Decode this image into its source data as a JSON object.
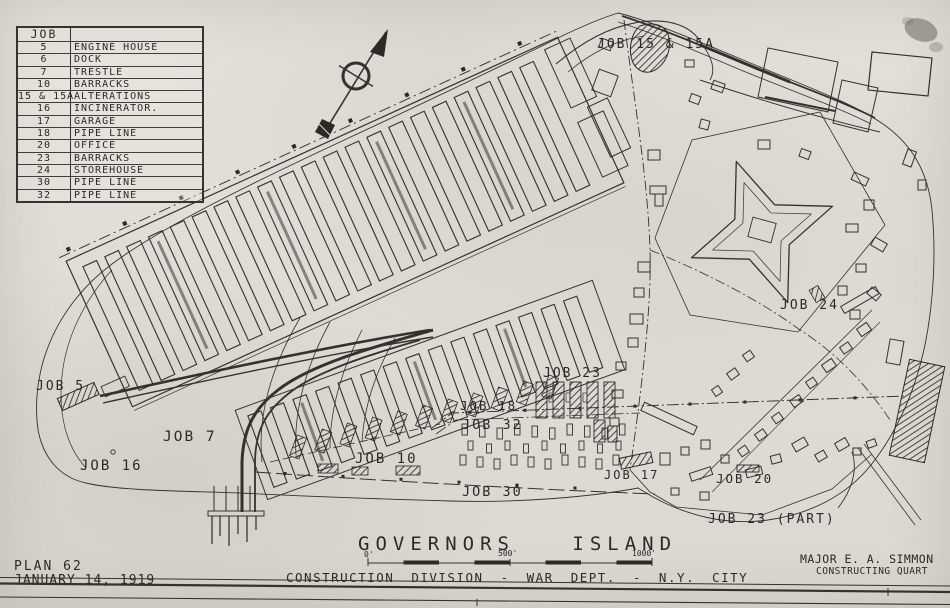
{
  "legend": {
    "header": "JOB",
    "rows": [
      {
        "job": "5",
        "name": "ENGINE HOUSE"
      },
      {
        "job": "6",
        "name": "DOCK"
      },
      {
        "job": "7",
        "name": "TRESTLE"
      },
      {
        "job": "10",
        "name": "BARRACKS"
      },
      {
        "job": "15 & 15A",
        "name": "ALTERATIONS"
      },
      {
        "job": "16",
        "name": "INCINERATOR."
      },
      {
        "job": "17",
        "name": "GARAGE"
      },
      {
        "job": "18",
        "name": "PIPE LINE"
      },
      {
        "job": "20",
        "name": "OFFICE"
      },
      {
        "job": "23",
        "name": "BARRACKS"
      },
      {
        "job": "24",
        "name": "STOREHOUSE"
      },
      {
        "job": "30",
        "name": "PIPE LINE"
      },
      {
        "job": "32",
        "name": "PIPE LINE"
      }
    ]
  },
  "map_labels": {
    "job5": "JOB 5",
    "job7": "JOB 7",
    "job16": "JOB 16",
    "job10": "JOB 10",
    "job18": "JOB 18",
    "job32": "JOB 32",
    "job30": "JOB 30",
    "job23": "JOB 23",
    "job17": "JOB 17",
    "job20": "JOB 20",
    "job23_part": "JOB 23 (PART)",
    "job24": "JOB 24",
    "job15": "JOB 15 & 15A"
  },
  "title_block": {
    "island_title": "GOVERNORS ISLAND",
    "scale_tick_0": "0'",
    "scale_tick_500": "500'",
    "scale_tick_1000": "1000'",
    "division_line": "CONSTRUCTION DIVISION - WAR DEPT. - N.Y. CITY",
    "plan_number": "PLAN 62",
    "plan_date": "JANUARY 14, 1919",
    "officer_name": "MAJOR E. A. SIMMON",
    "officer_title": "CONSTRUCTING QUART"
  }
}
